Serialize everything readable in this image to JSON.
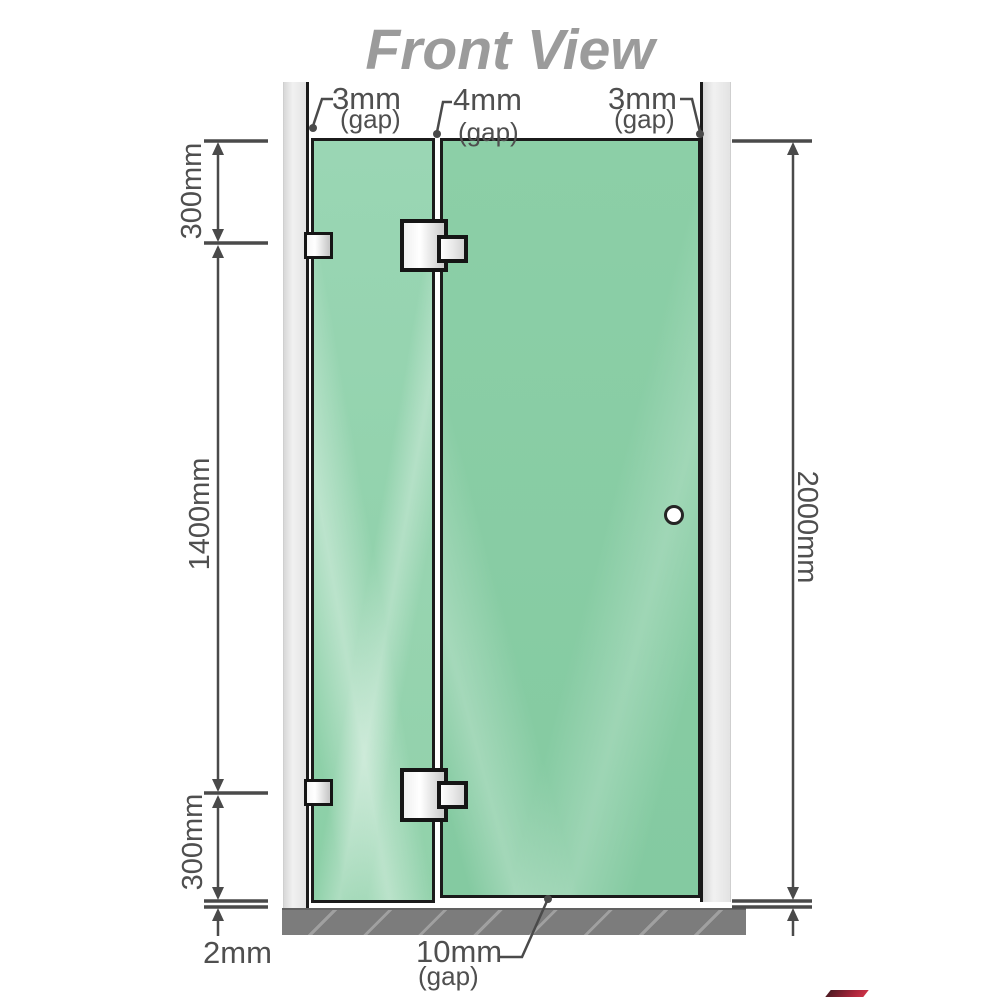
{
  "title": "Front View",
  "diagram": {
    "type": "technical-dimension-drawing",
    "subject": "frameless shower screen, front view: fixed glass panel with wall brackets, hinged glass door with handle, between two walls above a floor base"
  },
  "labels": {
    "gap_left": {
      "value": "3mm",
      "unit": "(gap)"
    },
    "gap_middle": {
      "value": "4mm",
      "unit": "(gap)"
    },
    "gap_right": {
      "value": "3mm",
      "unit": "(gap)"
    },
    "top_offset": "300mm",
    "middle_span": "1400mm",
    "bottom_offset": "300mm",
    "floor_clearance": "2mm",
    "total_height": "2000mm",
    "door_bottom_gap": {
      "value": "10mm",
      "unit": "(gap)"
    }
  },
  "colors": {
    "glass_green": "#8fd0ab",
    "glass_door_green": "#85cba2",
    "wall_gray": "#e8e8e8",
    "floor_gray": "#7c7c7c",
    "outline_black": "#1b1b1b",
    "dimension_gray": "#4a4a4a",
    "title_gray": "#9b9b9b",
    "hardware_white": "#f4f4f4"
  }
}
